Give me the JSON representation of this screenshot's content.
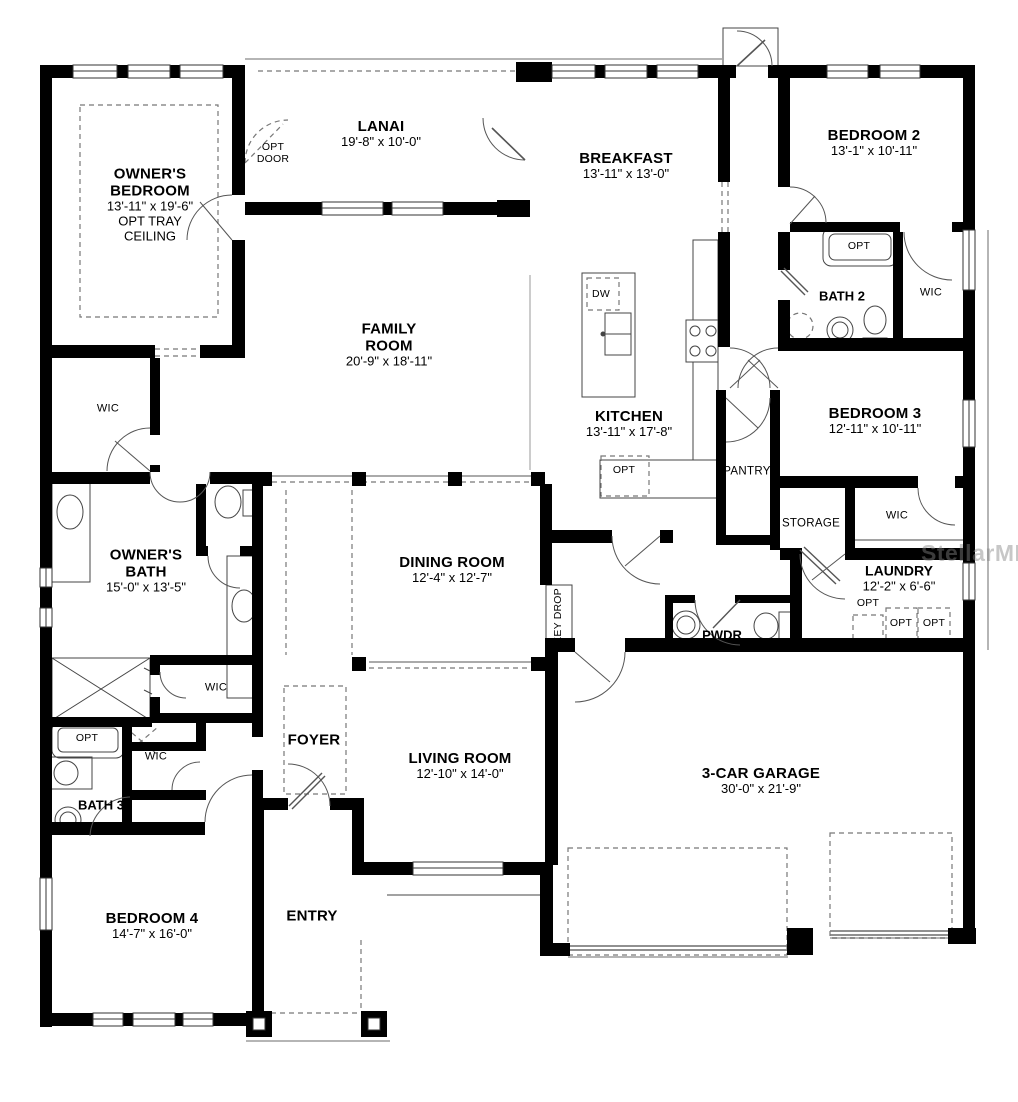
{
  "watermark": "StellarMLS",
  "labels": {
    "wic": "WIC",
    "opt": "OPT",
    "dw": "DW",
    "opt_door": "OPT DOOR",
    "key_drop": "KEY DROP",
    "pantry": "PANTRY",
    "storage": "STORAGE",
    "pwdr": "PWDR"
  },
  "rooms": {
    "owners_bedroom": {
      "name": "OWNER'S BEDROOM",
      "dims": "13'-11\" x 19'-6\"",
      "note": "OPT TRAY CEILING"
    },
    "lanai": {
      "name": "LANAI",
      "dims": "19'-8\" x 10'-0\""
    },
    "breakfast": {
      "name": "BREAKFAST",
      "dims": "13'-11\" x 13'-0\""
    },
    "bedroom2": {
      "name": "BEDROOM 2",
      "dims": "13'-1\" x 10'-11\""
    },
    "bath2": {
      "name": "BATH 2"
    },
    "family_room": {
      "name": "FAMILY ROOM",
      "dims": "20'-9\" x 18'-11\""
    },
    "kitchen": {
      "name": "KITCHEN",
      "dims": "13'-11\" x 17'-8\""
    },
    "bedroom3": {
      "name": "BEDROOM 3",
      "dims": "12'-11\" x 10'-11\""
    },
    "laundry": {
      "name": "LAUNDRY",
      "dims": "12'-2\" x 6'-6\""
    },
    "dining_room": {
      "name": "DINING ROOM",
      "dims": "12'-4\" x 12'-7\""
    },
    "owners_bath": {
      "name": "OWNER'S BATH",
      "dims": "15'-0\" x 13'-5\""
    },
    "bath3": {
      "name": "BATH 3"
    },
    "bedroom4": {
      "name": "BEDROOM 4",
      "dims": "14'-7\" x 16'-0\""
    },
    "foyer": {
      "name": "FOYER"
    },
    "living_room": {
      "name": "LIVING ROOM",
      "dims": "12'-10\" x 14'-0\""
    },
    "entry": {
      "name": "ENTRY"
    },
    "garage": {
      "name": "3-CAR GARAGE",
      "dims": "30'-0\" x 21'-9\""
    }
  }
}
